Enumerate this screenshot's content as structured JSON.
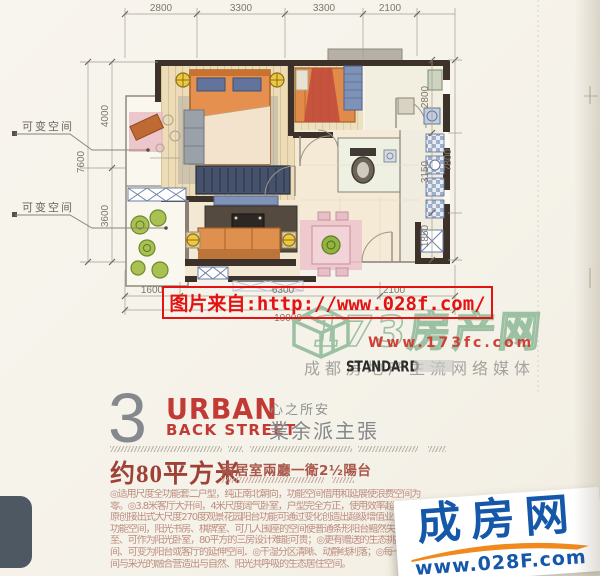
{
  "colors": {
    "accent_red": "#e51212",
    "title_red": "#c23a34",
    "area_red": "#9e4136",
    "logo_blue": "#1557a8",
    "logo_orange": "#f08a1d",
    "watermark_green": "#9cc0a2",
    "wall_dark": "#3d322a"
  },
  "plan": {
    "dims_top": [
      "2800",
      "3300",
      "3300",
      "2100"
    ],
    "dims_left_inner": [
      "4000",
      "3600"
    ],
    "dims_left_outer": "7600",
    "dims_right_inner": [
      "2800",
      "3150",
      "1850"
    ],
    "dims_right_outer": "7800",
    "dims_bottom": [
      "1600",
      "6300",
      "2100"
    ],
    "dims_bottom_total": "10000",
    "flex_label_1": "可变空间",
    "flex_label_2": "可变空间"
  },
  "watermark_red": {
    "text": "图片来自:http://www.028f.com/"
  },
  "watermark_173": {
    "site_name": "173房产网",
    "url": "Www.173fc.com",
    "slogan": "成都房地产主流网络媒体",
    "standard_label": "STANDARD"
  },
  "section": {
    "number": "3",
    "title_line1": "URBAN",
    "title_line2": "BACK STREET",
    "sub_cn_1": "心之所安",
    "sub_cn_2": "業余派主張",
    "area": "约80平方米",
    "layout": "兩居室兩廳一衛2½陽台"
  },
  "body": {
    "lines": [
      "◎适用尺度全功能套二户型，纯正南北朝向，功能空间借用和延展使浪费空间为",
      "零。◎3.8米客厅大开间，4米尺度阔气卧室，户型完全方正，使用效率超大。◎",
      "原创接出式大尺度270度观景花园阳台功能可通过变化创造出超级增值业主私密",
      "功能空间，阳光书房、棋牌室、可几人围座的空间使普通条形阳台黯然失色；甚",
      "至、可作为阳光卧室，80平方的三房设计难能可贵；◎更有赠送的生态挑板空",
      "间、可变为阳台或客厅的延伸空间．◎干湿分区清晰、动静线利落；◎每一个房",
      "间与采光的融合营造出与自然、阳光共呼吸的生态居住空间。"
    ]
  },
  "logo_028": {
    "name": "成房网",
    "url": "www.028F.com"
  }
}
